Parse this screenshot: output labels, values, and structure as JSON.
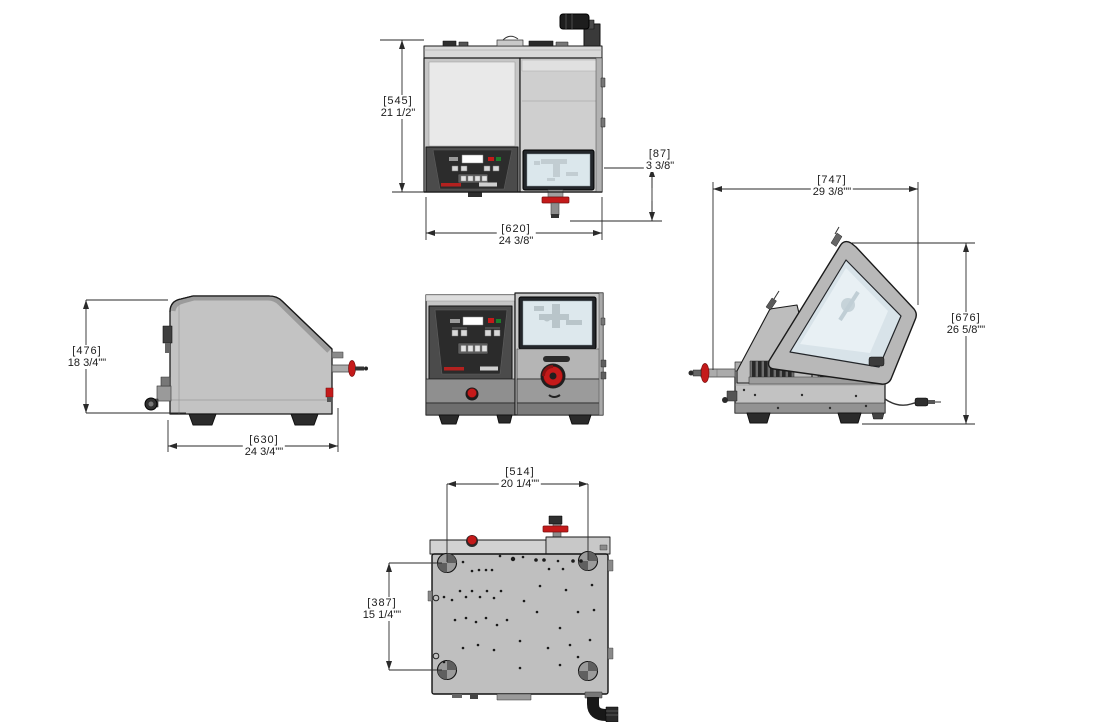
{
  "dimensions": {
    "front_height": {
      "mm": "[545]",
      "inch": "21 1/2\""
    },
    "drain_height": {
      "mm": "[87]",
      "inch": "3 3/8\""
    },
    "front_width": {
      "mm": "[620]",
      "inch": "24 3/8\""
    },
    "side_height": {
      "mm": "[476]",
      "inch": "18 3/4\"\""
    },
    "side_depth": {
      "mm": "[630]",
      "inch": "24 3/4\"\""
    },
    "open_lid_depth": {
      "mm": "[747]",
      "inch": "29 3/8\"\""
    },
    "open_lid_height": {
      "mm": "[676]",
      "inch": "26 5/8\"\""
    },
    "bottom_width": {
      "mm": "[514]",
      "inch": "20 1/4\"\""
    },
    "bottom_depth": {
      "mm": "[387]",
      "inch": "15 1/4\"\""
    }
  },
  "colors": {
    "accent_red": "#c41a1a",
    "indicator_green": "#1e7d2c",
    "body_gray": "#c6c6c6",
    "panel_dark": "#2c2c2c",
    "window_blue": "#dde8ed",
    "line": "#1a1a1a"
  }
}
